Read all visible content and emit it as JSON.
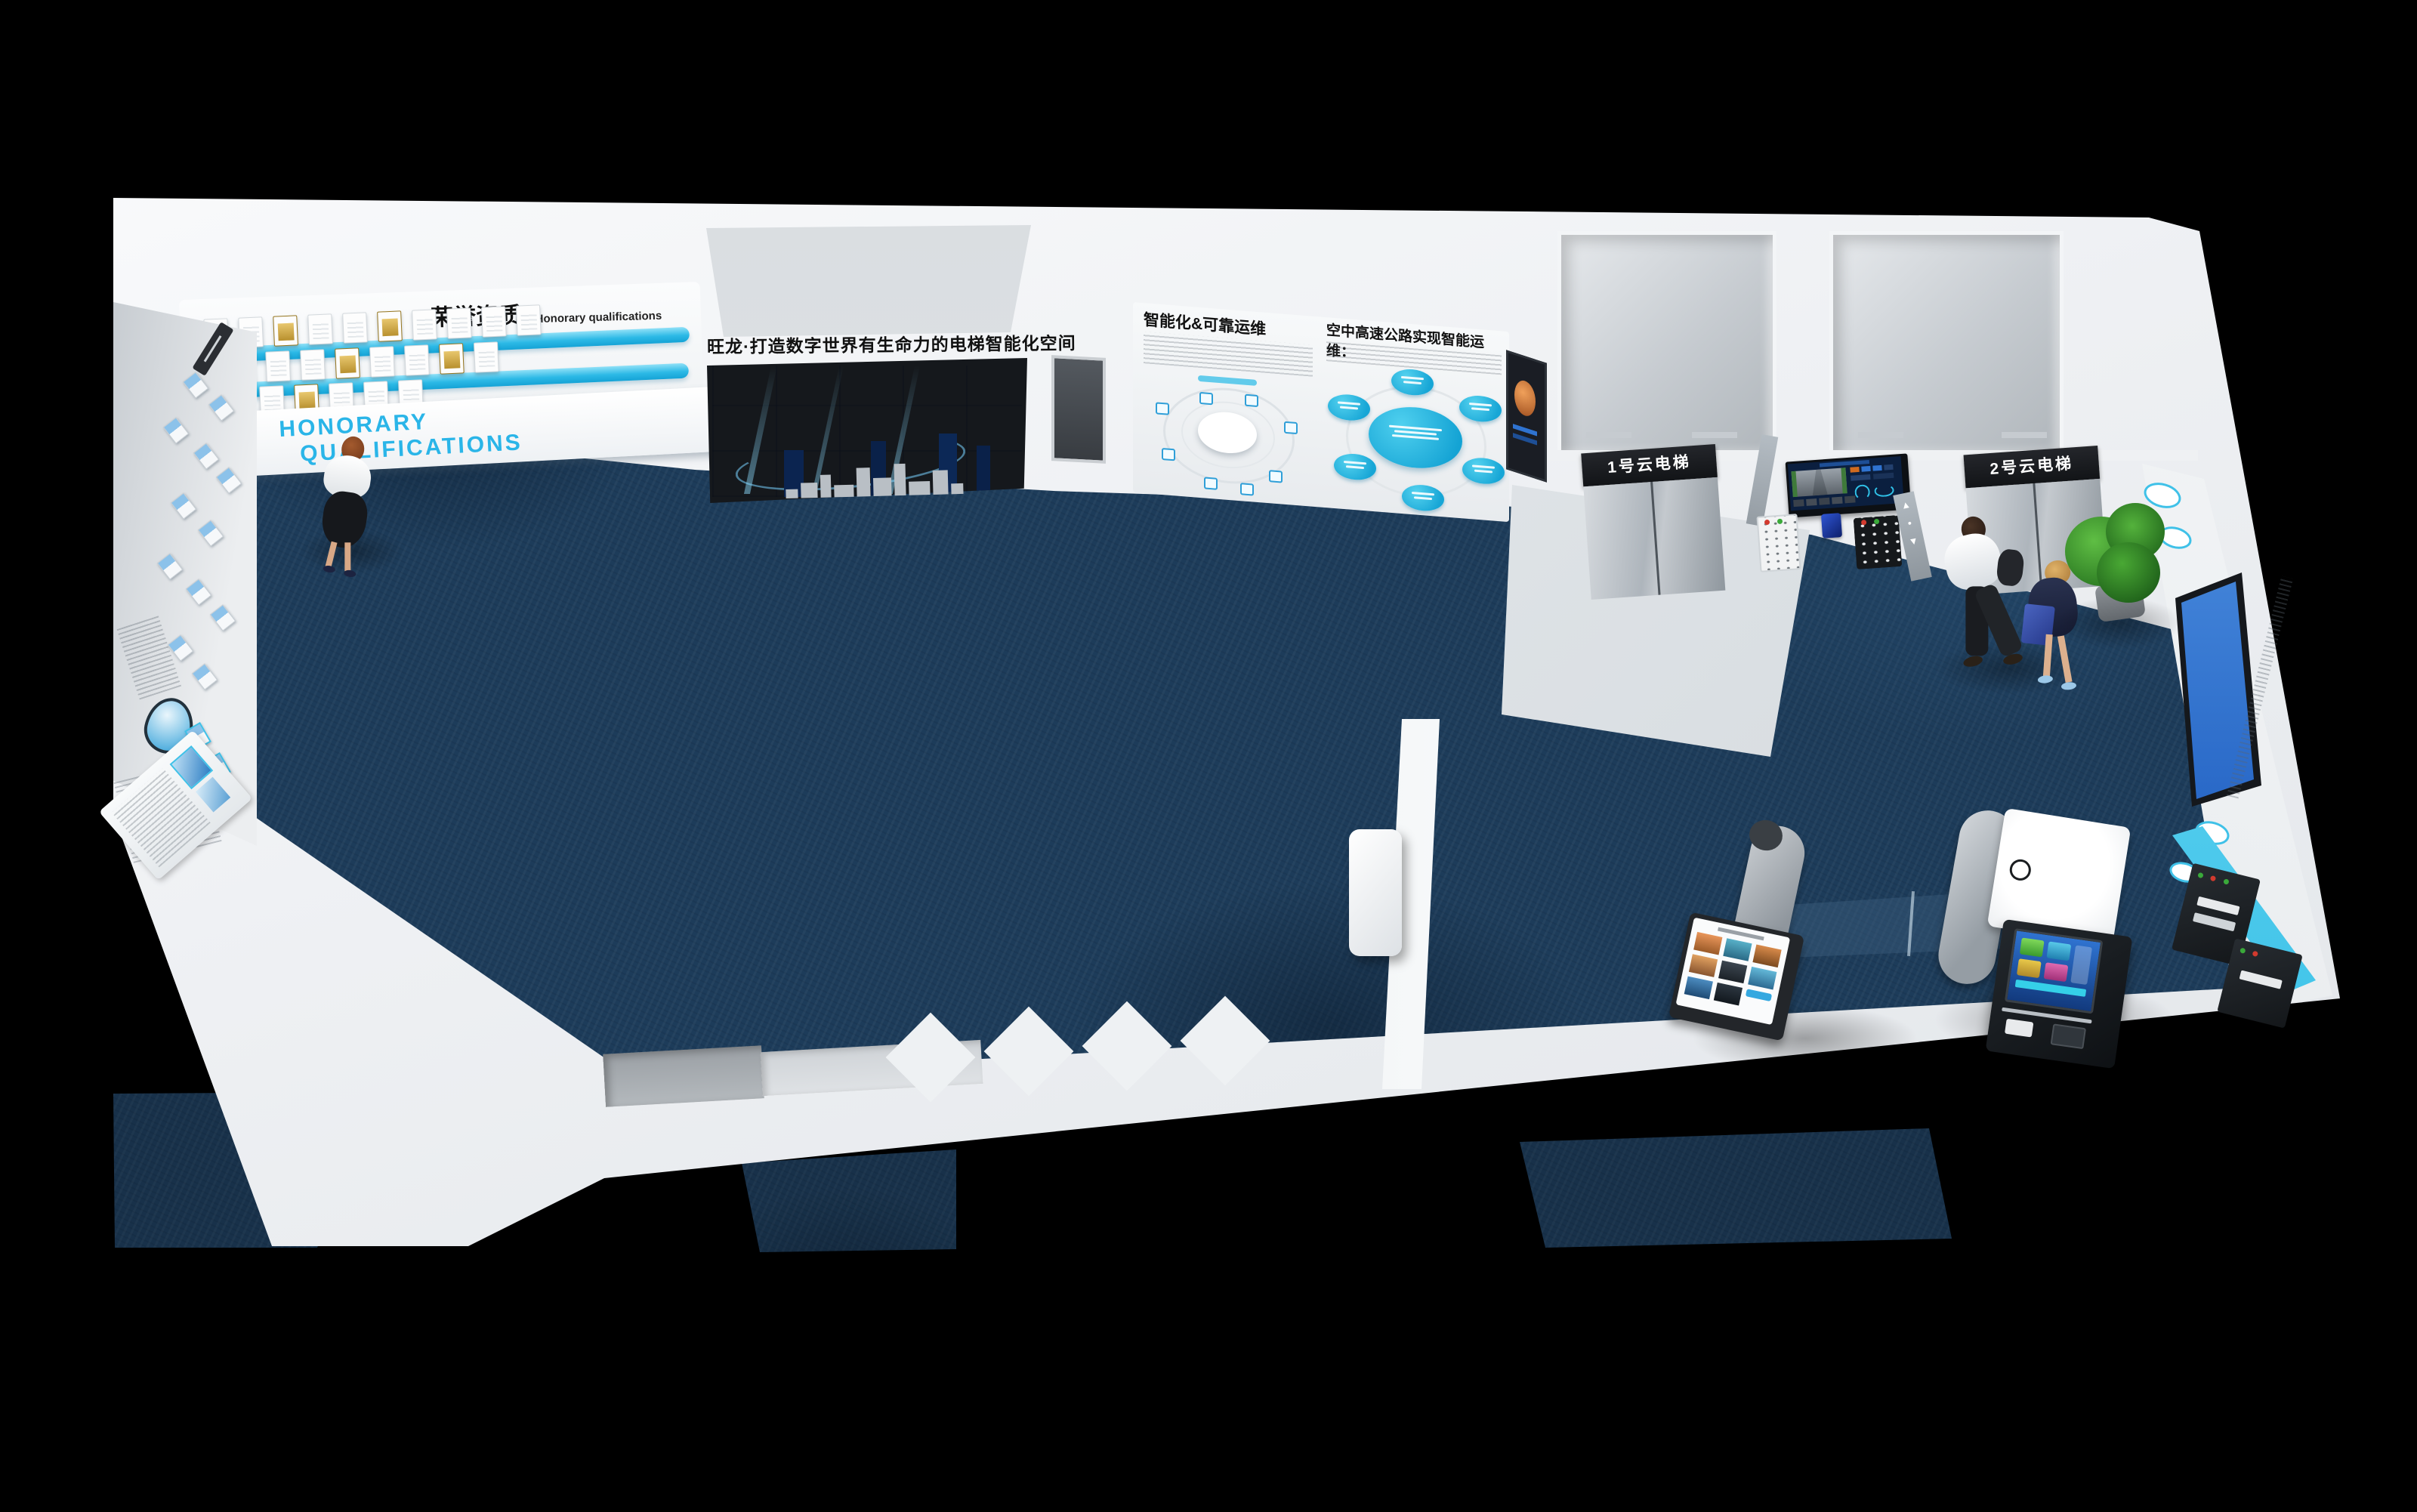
{
  "scene": {
    "description": "Top-down 3D render of an elevator showroom exhibition hall",
    "colors": {
      "accent_cyan": "#2AB5E8",
      "carpet_blue": "#1D3C5A",
      "wall_white": "#F2F4F6",
      "certificate_gold": "#C9A227",
      "screen_blue": "#1E5FC2",
      "sign_black": "#1A1C1F",
      "plant_green": "#3E9A2F"
    }
  },
  "banner": {
    "text": "旺龙·打造数字世界有生命力的电梯智能化空间"
  },
  "honorary_wall": {
    "title_cn": "荣誉资质",
    "title_en": "Honorary qualifications",
    "fascia_line1": "HONORARY",
    "fascia_line2": "QUALIFICATIONS"
  },
  "infographic_wall": {
    "left_title": "智能化&可靠运维",
    "right_title": "空中高速公路实现智能运维："
  },
  "elevator_hall": {
    "elevator1_sign": "1号云电梯",
    "elevator2_sign": "2号云电梯",
    "pillar_icons": {
      "up": "▲",
      "dot": "●",
      "down": "▼"
    }
  }
}
